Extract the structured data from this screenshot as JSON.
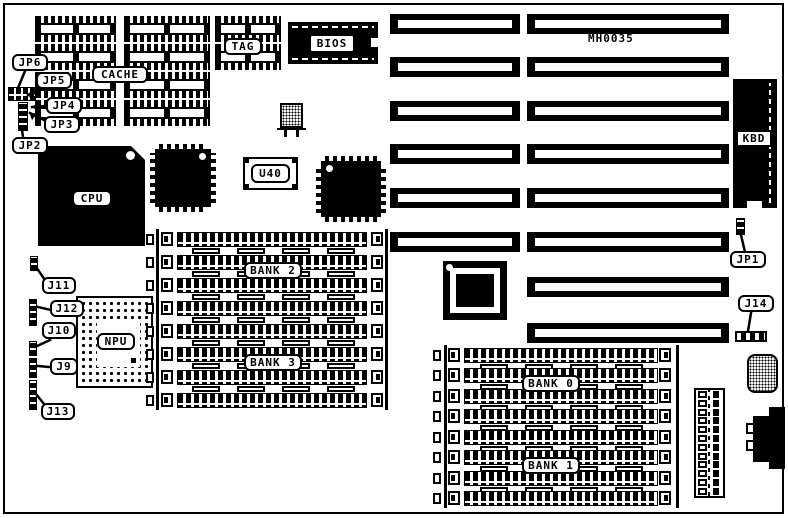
{
  "board": {
    "part_number": "MH0035"
  },
  "chips": {
    "cache": "CACHE",
    "tag": "TAG",
    "bios": "BIOS",
    "u40": "U40",
    "cpu": "CPU",
    "npu": "NPU",
    "kbd": "KBD"
  },
  "banks": {
    "bank0": "BANK 0",
    "bank1": "BANK 1",
    "bank2": "BANK 2",
    "bank3": "BANK 3"
  },
  "jumpers": {
    "jp1": "JP1",
    "jp2": "JP2",
    "jp3": "JP3",
    "jp4": "JP4",
    "jp5": "JP5",
    "jp6": "JP6",
    "j9": "J9",
    "j10": "J10",
    "j11": "J11",
    "j12": "J12",
    "j13": "J13",
    "j14": "J14"
  }
}
